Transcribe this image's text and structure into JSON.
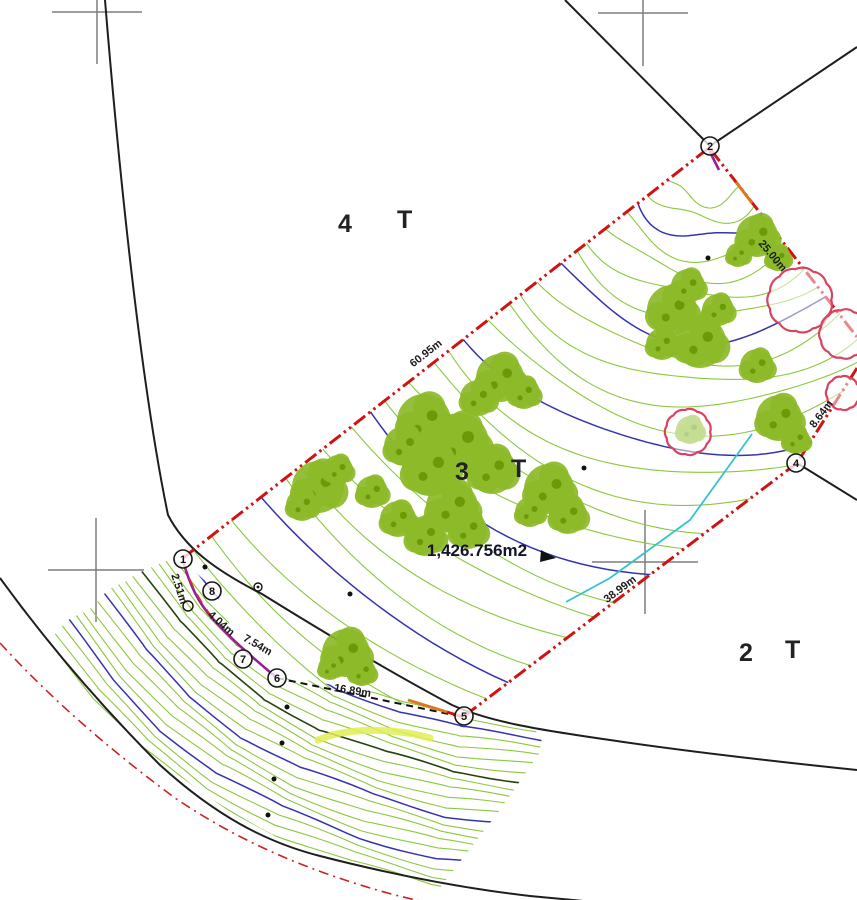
{
  "lot_labels": [
    {
      "id": "lot-4",
      "number": "4",
      "type": "T"
    },
    {
      "id": "lot-3",
      "number": "3",
      "type": "T"
    },
    {
      "id": "lot-2",
      "number": "2",
      "type": "T"
    }
  ],
  "area_label": "1,426.756m2",
  "dimension_labels": [
    {
      "edge": "1-2",
      "text": "60.95m"
    },
    {
      "edge": "2-3",
      "text": "25.00m"
    },
    {
      "edge": "3-4",
      "text": "8.64m"
    },
    {
      "edge": "4-5",
      "text": "38.99m"
    },
    {
      "edge": "5-6",
      "text": "16.89m"
    },
    {
      "edge": "6-7",
      "text": "7.54m"
    },
    {
      "edge": "7-8",
      "text": "4.04m"
    },
    {
      "edge": "8-1",
      "text": "2.51m"
    }
  ],
  "corner_markers": [
    "1",
    "2",
    "4",
    "5",
    "6",
    "7",
    "8"
  ],
  "colors": {
    "contour_minor": "#8bc83f",
    "contour_index": "#3434b0",
    "contour_dark": "#24430e",
    "boundary_red": "#cf1313",
    "boundary_purple": "#9b1d96",
    "tree_green": "#8cba28",
    "tree_green_dark": "#6b9a07",
    "tree_red_outline": "#d8435f",
    "drain_cyan": "#35c2d4",
    "highlight_yellow": "#e0ef55",
    "grid_gray": "#7e7e7e",
    "line_black": "#1e1e1e"
  }
}
